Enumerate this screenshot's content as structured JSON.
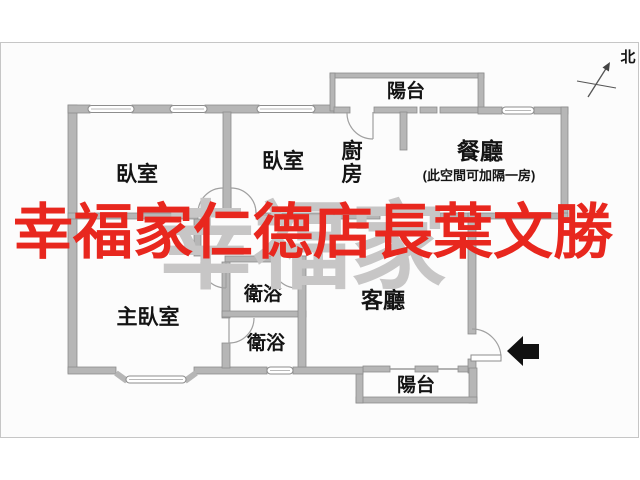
{
  "plan": {
    "title": "apartment-floor-plan",
    "rooms": {
      "bedroom1": "臥室",
      "bedroom2": "臥室",
      "kitchen_line1": "廚",
      "kitchen_line2": "房",
      "dining": "餐廳",
      "dining_note": "(此空間可加隔一房)",
      "master_bedroom": "主臥室",
      "bathroom1": "衛浴",
      "bathroom2": "衛浴",
      "living": "客廳",
      "balcony_top": "陽台",
      "balcony_bottom": "陽台"
    },
    "compass": {
      "label": "北"
    }
  },
  "watermark": {
    "front_text": "幸福家仁德店長葉文勝",
    "front_color": "#e8271e",
    "back_text": "幸福家",
    "back_color": "#c7c6c6"
  },
  "colors": {
    "wall_fill": "#b6b6b6",
    "wall_edge": "#8d8d8d",
    "thin_line": "#a0a0a0",
    "frame": "#c6c6c6",
    "plan_background": "#fcfcfc",
    "entry_arrow": "#111111"
  }
}
